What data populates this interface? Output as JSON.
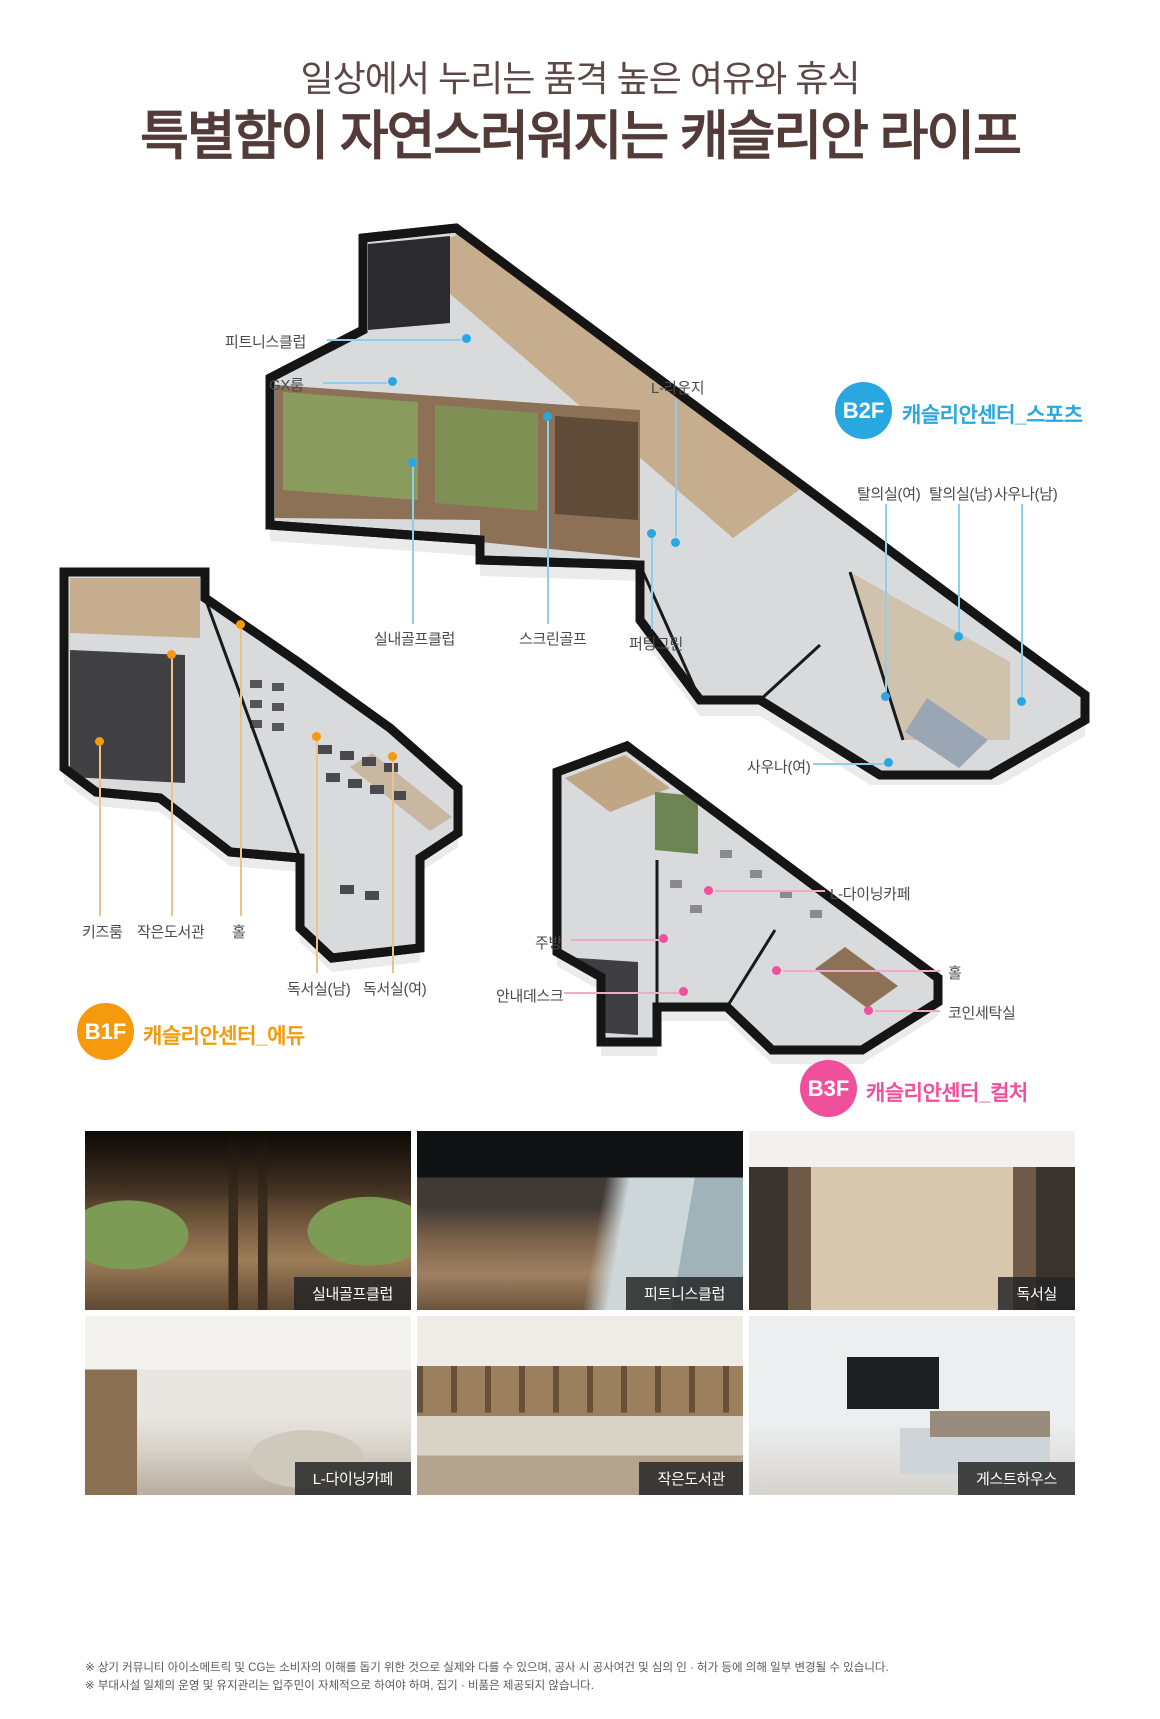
{
  "header": {
    "subtitle": "일상에서 누리는 품격 높은 여유와 휴식",
    "title": "특별함이 자연스러워지는 캐슬리안 라이프"
  },
  "colors": {
    "b2f_accent": "#29a7e0",
    "b1f_accent": "#f59a0d",
    "b3f_accent": "#f0509b",
    "title_brown": "#523b39"
  },
  "floors": {
    "b2f": {
      "badge": "B2F",
      "name": "캐슬리안센터_스포츠",
      "callouts": {
        "fitness": "피트니스클럽",
        "gx": "GX룸",
        "lounge": "L-라운지",
        "locker_w": "탈의실(여)",
        "locker_m": "탈의실(남)",
        "sauna_m": "사우나(남)",
        "golf_club": "실내골프클럽",
        "screen_golf": "스크린골프",
        "putting_green": "퍼팅그린",
        "sauna_w": "사우나(여)"
      }
    },
    "b1f": {
      "badge": "B1F",
      "name": "캐슬리안센터_에듀",
      "callouts": {
        "kids": "키즈룸",
        "library": "작은도서관",
        "hall": "홀",
        "reading_m": "독서실(남)",
        "reading_w": "독서실(여)"
      }
    },
    "b3f": {
      "badge": "B3F",
      "name": "캐슬리안센터_컬처",
      "callouts": {
        "dining_cafe": "L-다이닝카페",
        "kitchen": "주방",
        "info_desk": "안내데스크",
        "hall": "홀",
        "laundry": "코인세탁실"
      }
    }
  },
  "photos": [
    {
      "label": "실내골프클럽"
    },
    {
      "label": "피트니스클럽"
    },
    {
      "label": "독서실"
    },
    {
      "label": "L-다이닝카페"
    },
    {
      "label": "작은도서관"
    },
    {
      "label": "게스트하우스"
    }
  ],
  "disclaimer": [
    "※ 상기 커뮤니티 아이소메트릭 및 CG는 소비자의 이해를 돕기 위한 것으로 실제와 다를 수 있으며, 공사 시 공사여건 및 심의 인 · 허가 등에 의해 일부 변경될 수 있습니다.",
    "※ 부대시설 일체의 운영 및 유지관리는 입주민이 자체적으로 하여야 하며, 집기 · 비품은 제공되지 않습니다."
  ]
}
